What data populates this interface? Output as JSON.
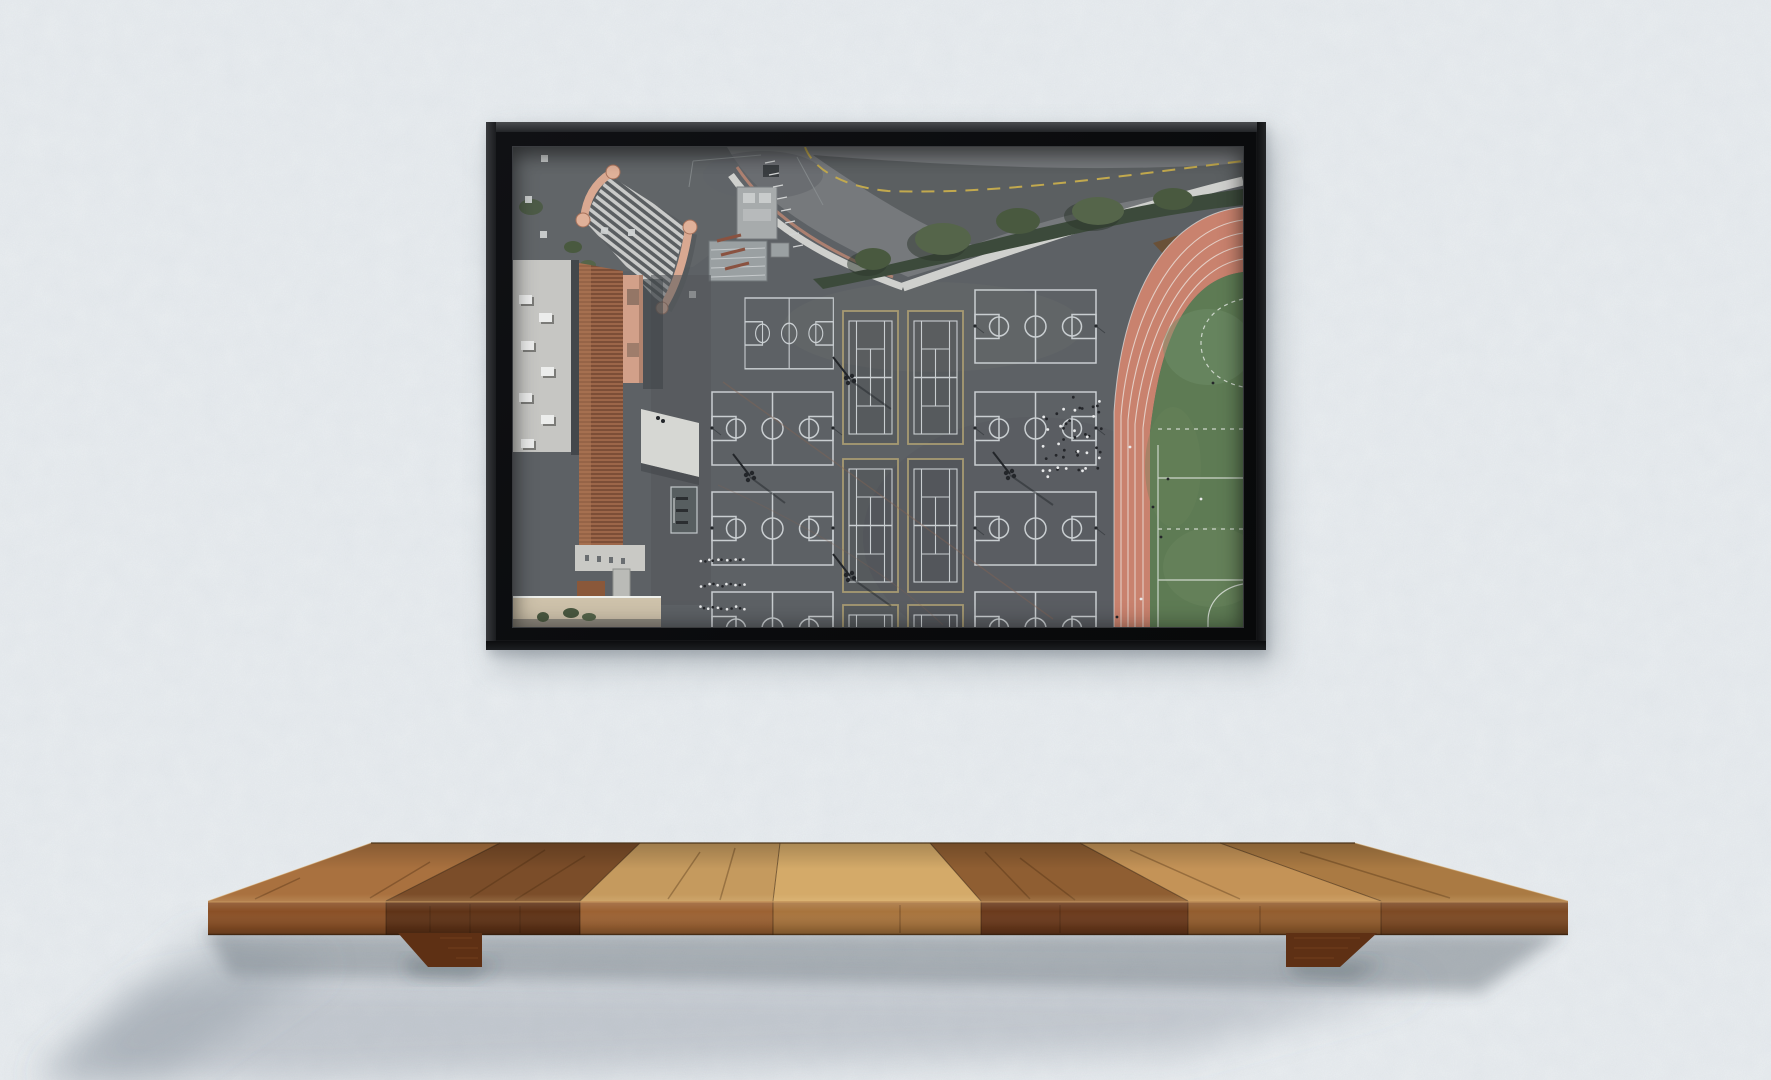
{
  "scene": {
    "description": "black floating frame with aerial photo of school sports courts, hung on stucco wall above a wooden plank shelf",
    "text_content": "none"
  },
  "wall": {
    "color": "#eaeef1",
    "texture": "stucco-noise"
  },
  "frame": {
    "color": "#141517",
    "inner_gap_color": "#0a0b0d",
    "lip_color": "#44474a"
  },
  "artwork": {
    "subject": "aerial view of playground with basketball courts, tennis courts, running track and green field",
    "palette": {
      "asphalt": "#5d6165",
      "asphalt_light": "#6b6e71",
      "road": "#76797c",
      "road_dark": "#575a5d",
      "sidewalk": "#cfd0cd",
      "curb": "#c08873",
      "hedge": "#3c4a3b",
      "tree_light": "#55654a",
      "tree_mid": "#49593f",
      "mulch": "#6a5138",
      "track": "#c9826e",
      "track_lane": "#e9dcd5",
      "field": "#5e7b54",
      "field_line": "#cdd6cb",
      "court_lines": "#c9ced1",
      "tennis_border": "#a79a72",
      "plaza_wall": "#d9a891",
      "tower_fill": "#e0b199",
      "stripe_light": "#c9cac9",
      "stripe_dark": "#5a5e61",
      "roof_light": "#9c6649",
      "roof_dark": "#7c4e37",
      "roof_gray": "#c6c6c3",
      "lower_wall": "#cec2ab",
      "pink_tower": "#d2a089",
      "crack": "#866352"
    },
    "counts": {
      "basketball_courts": 8,
      "tennis_courts": 6
    },
    "crowd": {
      "x": 530,
      "y": 250,
      "w": 62,
      "h": 80,
      "count": 48,
      "dark": "#24262a",
      "light": "#e8e9ea"
    },
    "queues": {
      "x0": 187,
      "step": 4.4,
      "count": 11,
      "rows": [
        {
          "y": 413
        },
        {
          "y": 438
        },
        {
          "y": 461
        }
      ],
      "dark": "#24262a",
      "light": "#e8e9ea"
    }
  },
  "shelf": {
    "top_plank_colors": [
      "#a9713f",
      "#7b4d29",
      "#c59a5e",
      "#d4aa69",
      "#8f5e32",
      "#c49357",
      "#aa7a43"
    ],
    "front_plank_colors": [
      "#8a5026",
      "#5f3317",
      "#9c6233",
      "#a8743d",
      "#6b3a1c",
      "#935d2e",
      "#7d4a24"
    ],
    "bracket_color": "#5e3014",
    "edge_highlight": "#d9a967"
  }
}
